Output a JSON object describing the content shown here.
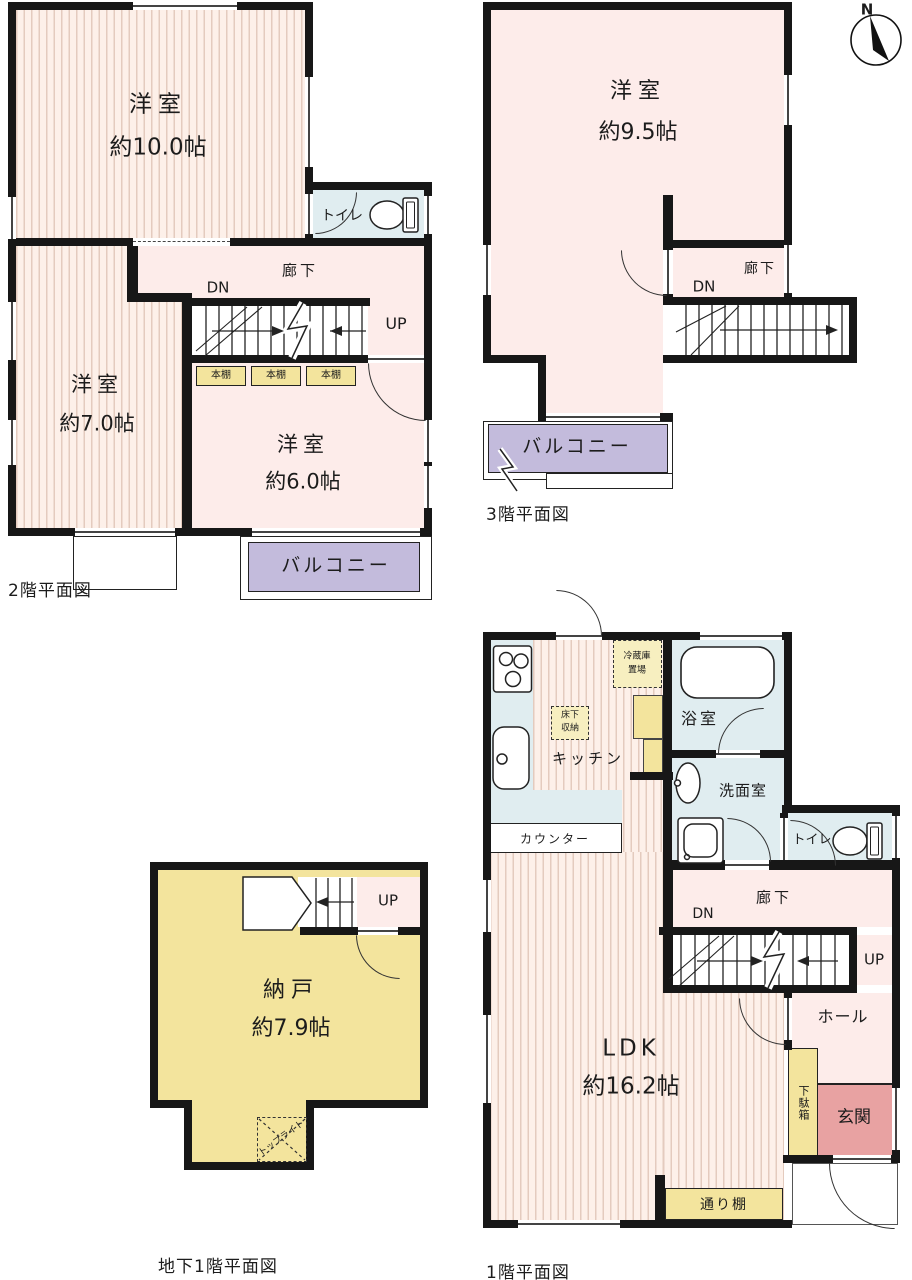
{
  "compass": {
    "north": "N"
  },
  "floor2": {
    "caption": "2階平面図",
    "room10_name": "洋室",
    "room10_area": "約10.0帖",
    "room7_name": "洋室",
    "room7_area": "約7.0帖",
    "room6_name": "洋室",
    "room6_area": "約6.0帖",
    "toilet": "トイレ",
    "hallway": "廊下",
    "dn": "DN",
    "up": "UP",
    "bookshelf1": "本棚",
    "bookshelf2": "本棚",
    "bookshelf3": "本棚",
    "balcony": "バルコニー"
  },
  "floor3": {
    "caption": "3階平面図",
    "room_name": "洋室",
    "room_area": "約9.5帖",
    "hallway": "廊下",
    "dn": "DN",
    "balcony": "バルコニー"
  },
  "floor1": {
    "caption": "1階平面図",
    "ldk_name": "LDK",
    "ldk_area": "約16.2帖",
    "kitchen": "キッチン",
    "counter": "カウンター",
    "fridge_line1": "冷蔵庫",
    "fridge_line2": "置場",
    "underfloor_line1": "床下",
    "underfloor_line2": "収納",
    "bath": "浴室",
    "washroom": "洗面室",
    "toilet": "トイレ",
    "hallway": "廊下",
    "dn": "DN",
    "up": "UP",
    "hall": "ホール",
    "shoe_cabinet": "下駄箱",
    "entrance": "玄関",
    "passage_shelf": "通り棚"
  },
  "basement": {
    "caption": "地下1階平面図",
    "storage_name": "納戸",
    "storage_area": "約7.9帖",
    "up": "UP",
    "under_stairs_line1": "階段下",
    "under_stairs_line2": "収納",
    "skylight": "トップライト"
  },
  "colors": {
    "wood_floor": "#fdf0e9",
    "plain_room": "#fdecea",
    "wet_area": "#e0edf0",
    "balcony": "#c3bbdc",
    "storage_yellow": "#f3e49d",
    "entrance": "#e8a2a2"
  }
}
